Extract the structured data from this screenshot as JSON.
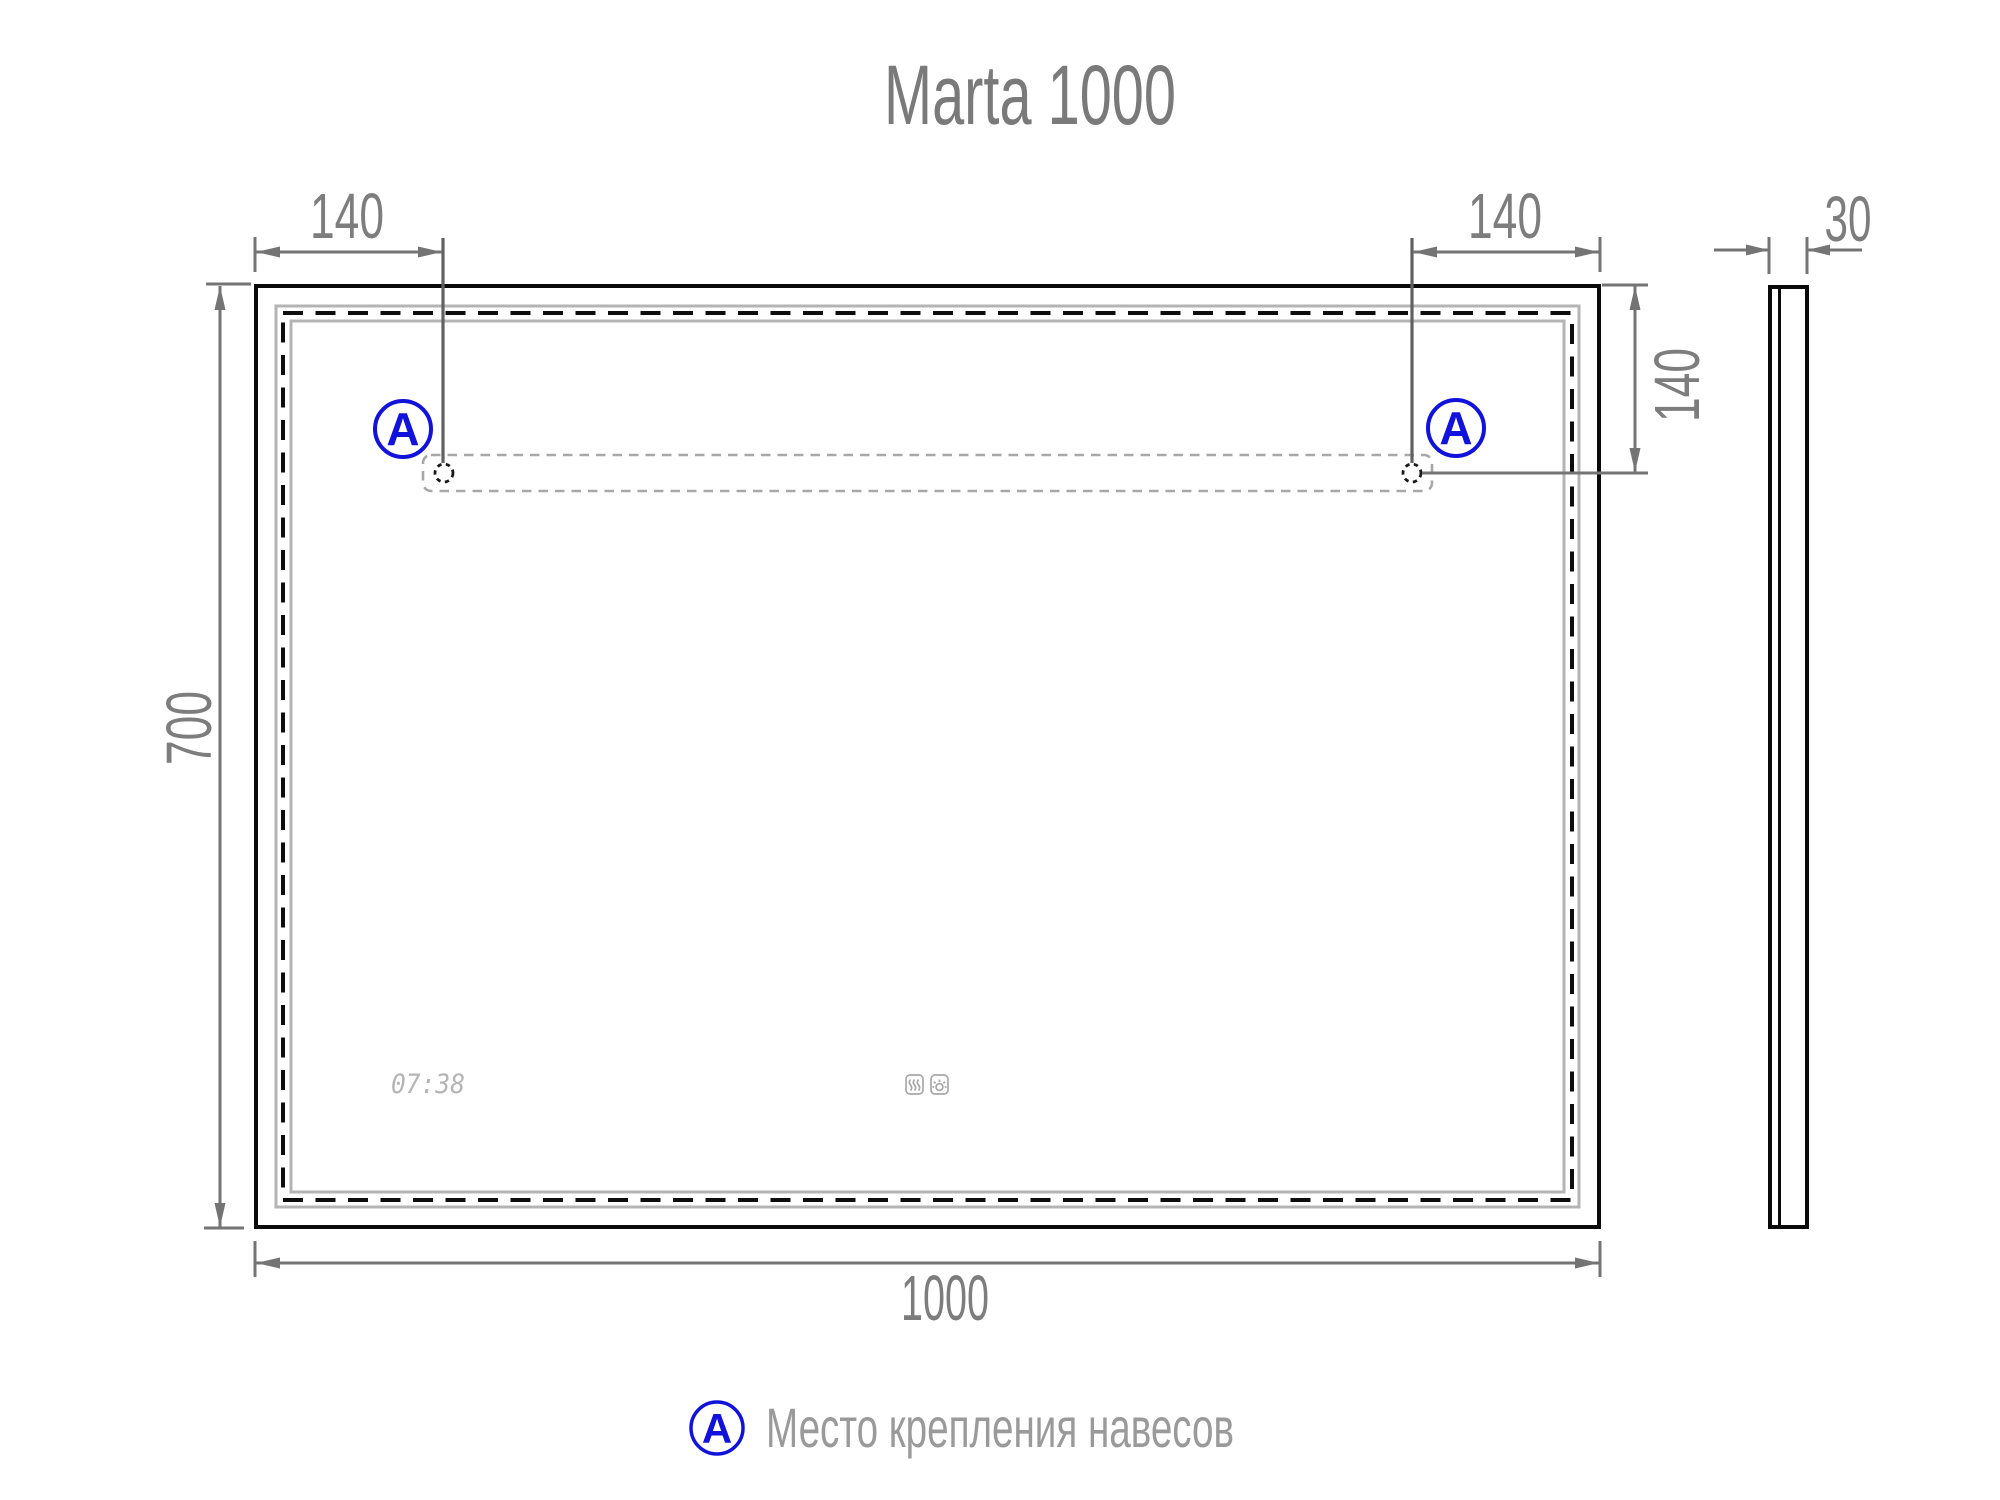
{
  "title": "Marta 1000",
  "dimensions": {
    "hanger_offset_left": "140",
    "hanger_offset_right": "140",
    "thickness": "30",
    "hanger_offset_top": "140",
    "height": "700",
    "width": "1000"
  },
  "marker": {
    "letter": "A"
  },
  "display": {
    "time": "07:38"
  },
  "icons": {
    "antifog": "anti-fog-heater-icon",
    "touch_light": "touch-light-sensor-icon"
  },
  "legend": {
    "marker_letter": "A",
    "label": "Место крепления навесов"
  },
  "colors": {
    "accent_blue": "#1212dd",
    "dimension_gray": "#747474",
    "text_gray": "#7d7d7d",
    "frame_black": "#0a0a0a",
    "frame_light_gray": "#b4b4b4",
    "display_gray": "#b5b5b5"
  }
}
